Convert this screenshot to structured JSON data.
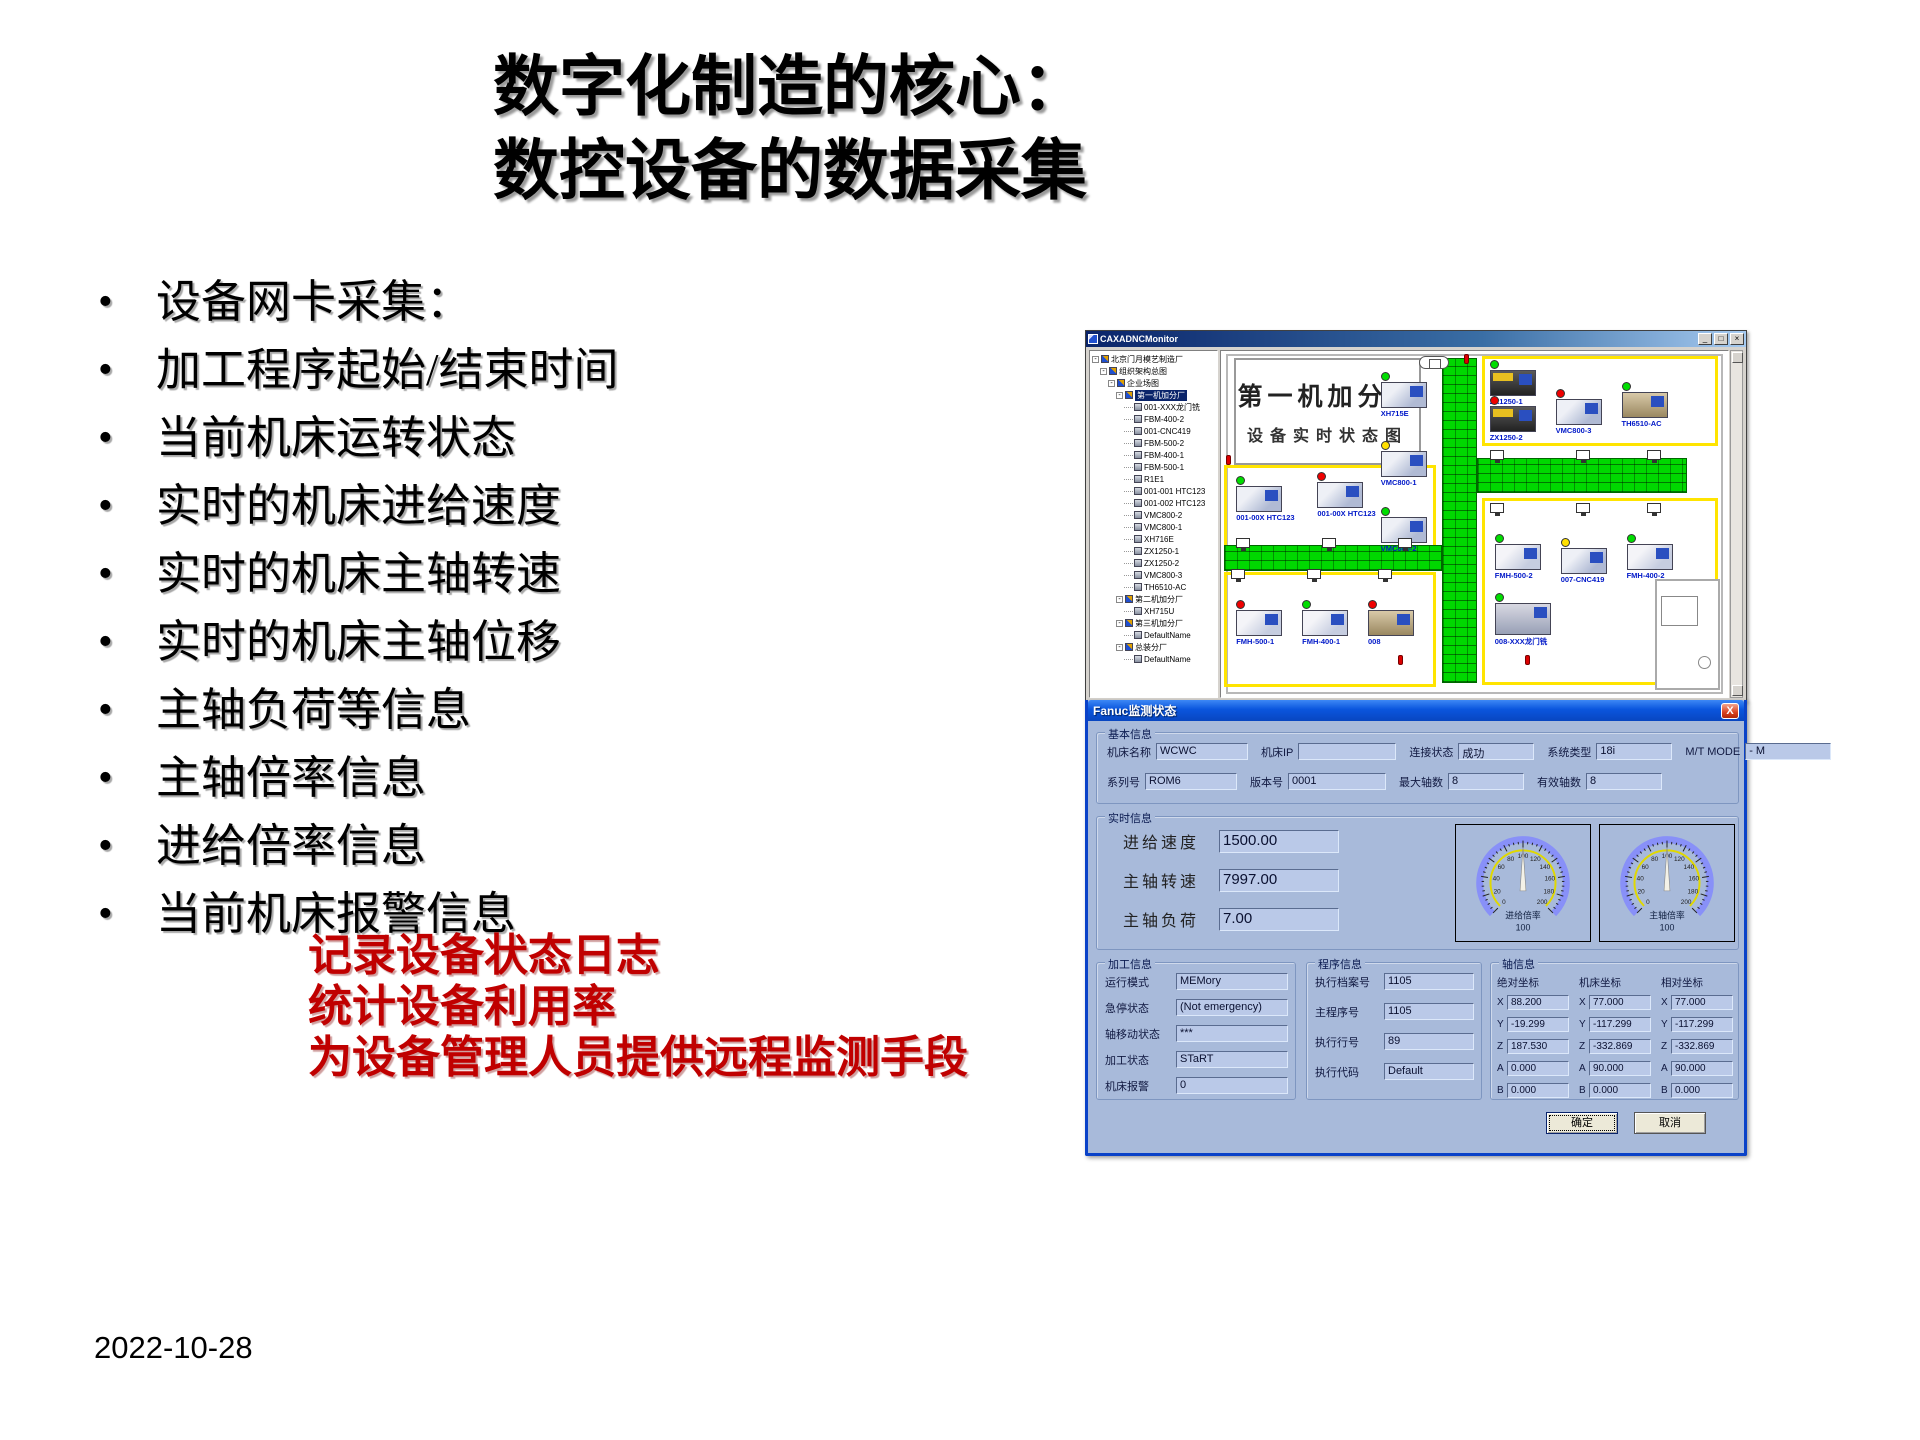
{
  "slide": {
    "title_lines": [
      "数字化制造的核心：",
      "数控设备的数据采集"
    ],
    "bullets": [
      "设备网卡采集：",
      "加工程序起始/结束时间",
      "当前机床运转状态",
      "实时的机床进给速度",
      "实时的机床主轴转速",
      "实时的机床主轴位移",
      "主轴负荷等信息",
      "主轴倍率信息",
      "进给倍率信息",
      "当前机床报警信息"
    ],
    "red_lines": [
      "记录设备状态日志",
      "统计设备利用率",
      "为设备管理人员提供远程监测手段"
    ],
    "red_color": "#c00000",
    "date": "2022-10-28"
  },
  "app": {
    "window_title": "CAXADNCMonitor",
    "window_buttons": [
      "_",
      "□",
      "×"
    ],
    "tree": {
      "items": [
        {
          "label": "北京门月模艺制造厂",
          "level": 0,
          "parent": true,
          "icon": "fac"
        },
        {
          "label": "组织架构总图",
          "level": 1,
          "parent": true,
          "icon": "fac"
        },
        {
          "label": "企业场图",
          "level": 2,
          "parent": true,
          "icon": "fac"
        },
        {
          "label": "第一机加分厂",
          "level": 3,
          "parent": true,
          "icon": "fac",
          "selected": true
        },
        {
          "label": "001-XXX龙门铣",
          "level": 4,
          "icon": "mach"
        },
        {
          "label": "FBM-400-2",
          "level": 4,
          "icon": "mach"
        },
        {
          "label": "001-CNC419",
          "level": 4,
          "icon": "mach"
        },
        {
          "label": "FBM-500-2",
          "level": 4,
          "icon": "mach"
        },
        {
          "label": "FBM-400-1",
          "level": 4,
          "icon": "mach"
        },
        {
          "label": "FBM-500-1",
          "level": 4,
          "icon": "mach"
        },
        {
          "label": "R1E1",
          "level": 4,
          "icon": "mach"
        },
        {
          "label": "001-001 HTC123",
          "level": 4,
          "icon": "mach"
        },
        {
          "label": "001-002 HTC123",
          "level": 4,
          "icon": "mach"
        },
        {
          "label": "VMC800-2",
          "level": 4,
          "icon": "mach"
        },
        {
          "label": "VMC800-1",
          "level": 4,
          "icon": "mach"
        },
        {
          "label": "XH716E",
          "level": 4,
          "icon": "mach"
        },
        {
          "label": "ZX1250-1",
          "level": 4,
          "icon": "mach"
        },
        {
          "label": "ZX1250-2",
          "level": 4,
          "icon": "mach"
        },
        {
          "label": "VMC800-3",
          "level": 4,
          "icon": "mach"
        },
        {
          "label": "TH6510-AC",
          "level": 4,
          "icon": "mach"
        },
        {
          "label": "第二机加分厂",
          "level": 3,
          "parent": true,
          "icon": "fac"
        },
        {
          "label": "XH715U",
          "level": 4,
          "icon": "mach"
        },
        {
          "label": "第三机加分厂",
          "level": 3,
          "parent": true,
          "icon": "fac"
        },
        {
          "label": "DefaultName",
          "level": 4,
          "icon": "mach"
        },
        {
          "label": "总装分厂",
          "level": 3,
          "parent": true,
          "icon": "fac"
        },
        {
          "label": "DefaultName",
          "level": 4,
          "icon": "mach"
        }
      ]
    },
    "map": {
      "title_line1": "第一机加分厂",
      "title_line2": "设备实时状态图",
      "machines": [
        {
          "label": "XH715E",
          "light": "green",
          "x": 31.5,
          "y": 6,
          "variant": "vmc"
        },
        {
          "label": "VMC800-1",
          "light": "yellow",
          "x": 31.5,
          "y": 26,
          "variant": "vmc"
        },
        {
          "label": "VMC800-2",
          "light": "green",
          "x": 31.5,
          "y": 45,
          "variant": "vmc"
        },
        {
          "label": "ZX1250-1",
          "light": "green",
          "x": 53,
          "y": 2.5,
          "variant": "inj"
        },
        {
          "label": "ZX1250-2",
          "light": "red",
          "x": 53,
          "y": 13,
          "variant": "inj"
        },
        {
          "label": "VMC800-3",
          "light": "red",
          "x": 66,
          "y": 11,
          "variant": "vmc"
        },
        {
          "label": "TH6510-AC",
          "light": "green",
          "x": 79,
          "y": 9,
          "variant": "lathe"
        },
        {
          "label": "001-00X HTC123",
          "light": "green",
          "x": 3,
          "y": 36,
          "variant": "htc"
        },
        {
          "label": "001-00X HTC123",
          "light": "red",
          "x": 19,
          "y": 35,
          "variant": "htc"
        },
        {
          "label": "FMH-500-2",
          "light": "green",
          "x": 54,
          "y": 53,
          "variant": "fmh"
        },
        {
          "label": "007-CNC419",
          "light": "yellow",
          "x": 67,
          "y": 54,
          "variant": "vmc"
        },
        {
          "label": "FMH-400-2",
          "light": "green",
          "x": 80,
          "y": 53,
          "variant": "fmh"
        },
        {
          "label": "FMH-500-1",
          "light": "red",
          "x": 3,
          "y": 72,
          "variant": "fmh"
        },
        {
          "label": "FMH-400-1",
          "light": "green",
          "x": 16,
          "y": 72,
          "variant": "fmh"
        },
        {
          "label": "008",
          "light": "red",
          "x": 29,
          "y": 72,
          "variant": "lathe"
        },
        {
          "label": "008-XXX龙门铣",
          "light": "green",
          "x": 54,
          "y": 70,
          "variant": "gantry"
        }
      ],
      "monitors": [
        {
          "x": 3,
          "y": 54
        },
        {
          "x": 20,
          "y": 54
        },
        {
          "x": 35,
          "y": 54
        },
        {
          "x": 53,
          "y": 28.5
        },
        {
          "x": 70,
          "y": 28.5
        },
        {
          "x": 84,
          "y": 28.5
        },
        {
          "x": 2,
          "y": 63
        },
        {
          "x": 17,
          "y": 63
        },
        {
          "x": 31,
          "y": 63
        },
        {
          "x": 53,
          "y": 44
        },
        {
          "x": 70,
          "y": 44
        },
        {
          "x": 84,
          "y": 44
        }
      ],
      "extinguishers": [
        {
          "x": 48,
          "y": 1
        },
        {
          "x": 1,
          "y": 30
        },
        {
          "x": 35,
          "y": 88
        },
        {
          "x": 60,
          "y": 88
        }
      ]
    }
  },
  "dialog": {
    "title": "Fanuc监测状态",
    "close_label": "X",
    "buttons": {
      "ok": "确定",
      "cancel": "取消"
    },
    "groups": {
      "basic": {
        "title": "基本信息",
        "row1": [
          {
            "label": "机床名称",
            "value": "WCWC"
          },
          {
            "label": "机床IP",
            "value": ""
          },
          {
            "label": "连接状态",
            "value": "成功"
          },
          {
            "label": "系统类型",
            "value": "18i"
          },
          {
            "label": "M/T MODE",
            "value": "- M"
          }
        ],
        "row2": [
          {
            "label": "系列号",
            "value": "ROM6"
          },
          {
            "label": "版本号",
            "value": "0001"
          },
          {
            "label": "最大轴数",
            "value": "8"
          },
          {
            "label": "有效轴数",
            "value": "8"
          }
        ]
      },
      "realtime": {
        "title": "实时信息",
        "fields": [
          {
            "label": "进给速度",
            "value": "1500.00"
          },
          {
            "label": "主轴转速",
            "value": "7997.00"
          },
          {
            "label": "主轴负荷",
            "value": "7.00"
          }
        ],
        "gauges": [
          {
            "label": "进给倍率",
            "value": 100,
            "min": 0,
            "max": 200,
            "number_step": 20
          },
          {
            "label": "主轴倍率",
            "value": 100,
            "min": 0,
            "max": 200,
            "number_step": 20
          }
        ]
      },
      "machining": {
        "title": "加工信息",
        "fields": [
          {
            "label": "运行模式",
            "value": "MEMory"
          },
          {
            "label": "急停状态",
            "value": "(Not emergency)"
          },
          {
            "label": "轴移动状态",
            "value": "***"
          },
          {
            "label": "加工状态",
            "value": "STaRT"
          },
          {
            "label": "机床报警",
            "value": "0"
          }
        ]
      },
      "program": {
        "title": "程序信息",
        "fields": [
          {
            "label": "执行档案号",
            "value": "1105"
          },
          {
            "label": "主程序号",
            "value": "1105"
          },
          {
            "label": "执行行号",
            "value": "89"
          },
          {
            "label": "执行代码",
            "value": "Default"
          }
        ]
      },
      "axes": {
        "title": "轴信息",
        "columns": [
          "绝对坐标",
          "机床坐标",
          "相对坐标"
        ],
        "rows": [
          {
            "axis": "X",
            "values": [
              "88.200",
              "77.000",
              "77.000"
            ]
          },
          {
            "axis": "Y",
            "values": [
              "-19.299",
              "-117.299",
              "-117.299"
            ]
          },
          {
            "axis": "Z",
            "values": [
              "187.530",
              "-332.869",
              "-332.869"
            ]
          },
          {
            "axis": "A",
            "values": [
              "0.000",
              "90.000",
              "90.000"
            ]
          },
          {
            "axis": "B",
            "values": [
              "0.000",
              "0.000",
              "0.000"
            ]
          }
        ]
      }
    }
  }
}
